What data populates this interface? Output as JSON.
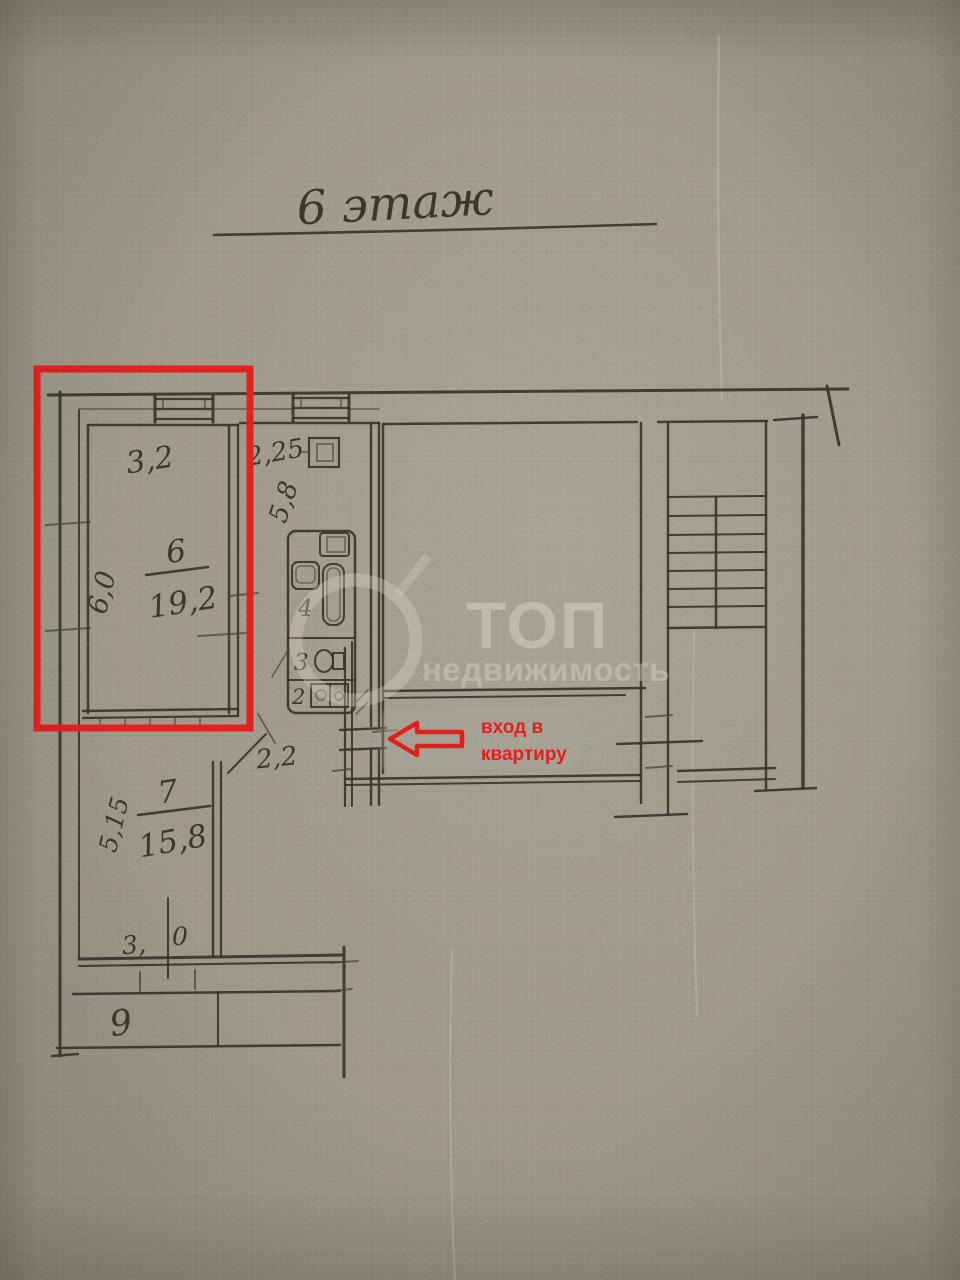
{
  "title": {
    "floor_label": "6 этаж"
  },
  "plan": {
    "room6": {
      "number": "6",
      "area": "19,2",
      "width": "3,2",
      "depth": "6,0"
    },
    "kitchen": {
      "width": "2,25",
      "depth": "5,8"
    },
    "bathroom": {
      "number": "4"
    },
    "wc": {
      "number": "3"
    },
    "storage": {
      "number": "2"
    },
    "hall": {
      "width": "2,2"
    },
    "room7": {
      "number": "7",
      "area": "15,8",
      "depth": "5,15",
      "balcony_door_dim_left": "3,",
      "balcony_door_dim_right": "0"
    },
    "balcony": {
      "number": "9"
    }
  },
  "annotations": {
    "entrance_line1": "вход в",
    "entrance_line2": "квартиру",
    "highlight_color": "#e5201d",
    "ink_color": "#39342a",
    "paper_color": "#9d9889"
  },
  "watermark": {
    "brand": "ТОП",
    "brand_sub": "недвижимость"
  }
}
